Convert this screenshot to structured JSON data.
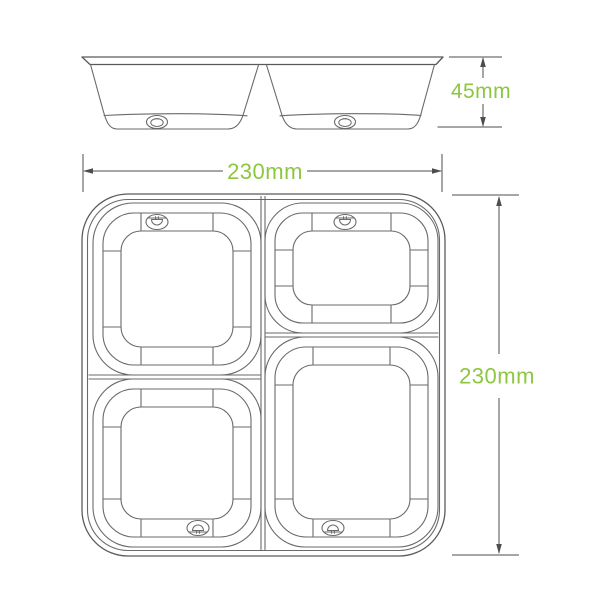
{
  "diagram": {
    "title": "4-compartment takeaway tray dimension drawing",
    "side_view": {
      "name": "side-elevation",
      "height_dimension": {
        "label": "45mm"
      }
    },
    "plan_view": {
      "name": "top-view-4-compartments",
      "width_dimension": {
        "label": "230mm"
      },
      "height_dimension": {
        "label": "230mm"
      },
      "compartments": [
        "top-left",
        "top-right",
        "bottom-left",
        "bottom-right"
      ]
    },
    "icons": {
      "tab": "pull-tab-icon"
    },
    "colors": {
      "dimension_text_green": "#8dc63f",
      "drawing_line": "#6a6a6a",
      "dimension_line": "#4d4d4d",
      "background": "#ffffff"
    }
  }
}
